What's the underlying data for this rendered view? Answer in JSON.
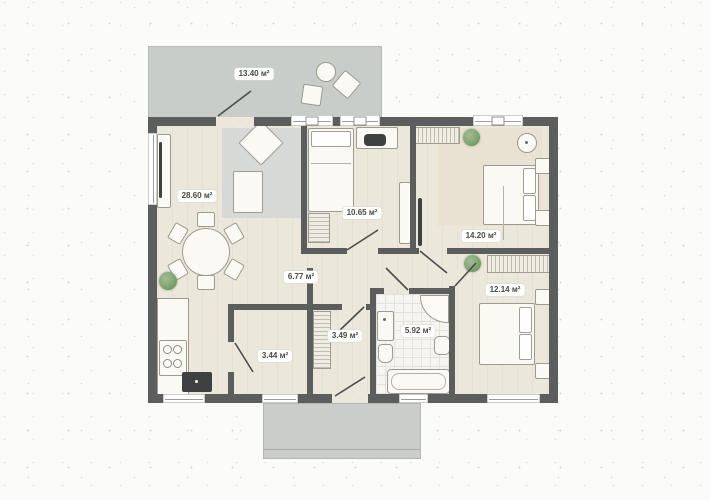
{
  "plan": {
    "type": "apartment-floor-plan",
    "rooms": [
      {
        "name": "terrace",
        "area": "13.40 м²"
      },
      {
        "name": "living-kitchen",
        "area": "28.60 м²"
      },
      {
        "name": "bedroom-small",
        "area": "10.65 м²"
      },
      {
        "name": "bedroom-master",
        "area": "14.20 м²"
      },
      {
        "name": "hallway",
        "area": "6.77 м²"
      },
      {
        "name": "bedroom-second",
        "area": "12.14 м²"
      },
      {
        "name": "bathroom",
        "area": "5.92 м²"
      },
      {
        "name": "pantry",
        "area": "3.44 м²"
      },
      {
        "name": "entry-hall",
        "area": "3.49 м²"
      }
    ],
    "colors": {
      "wall": "#5c5e5d",
      "floor": "#ece7db",
      "terrace": "#c9cdc9",
      "porch": "#cacdc9",
      "rug": "#d6d9d5",
      "rug_beige": "#e9e1d1",
      "dark_item": "#3f4140",
      "plant": "#7fa571",
      "furniture_fill": "#faf9f4",
      "furniture_border": "#9e9a90",
      "label_bg": "#ffffff",
      "label_text": "#4a4a46",
      "background": "#fbfbf9"
    }
  }
}
